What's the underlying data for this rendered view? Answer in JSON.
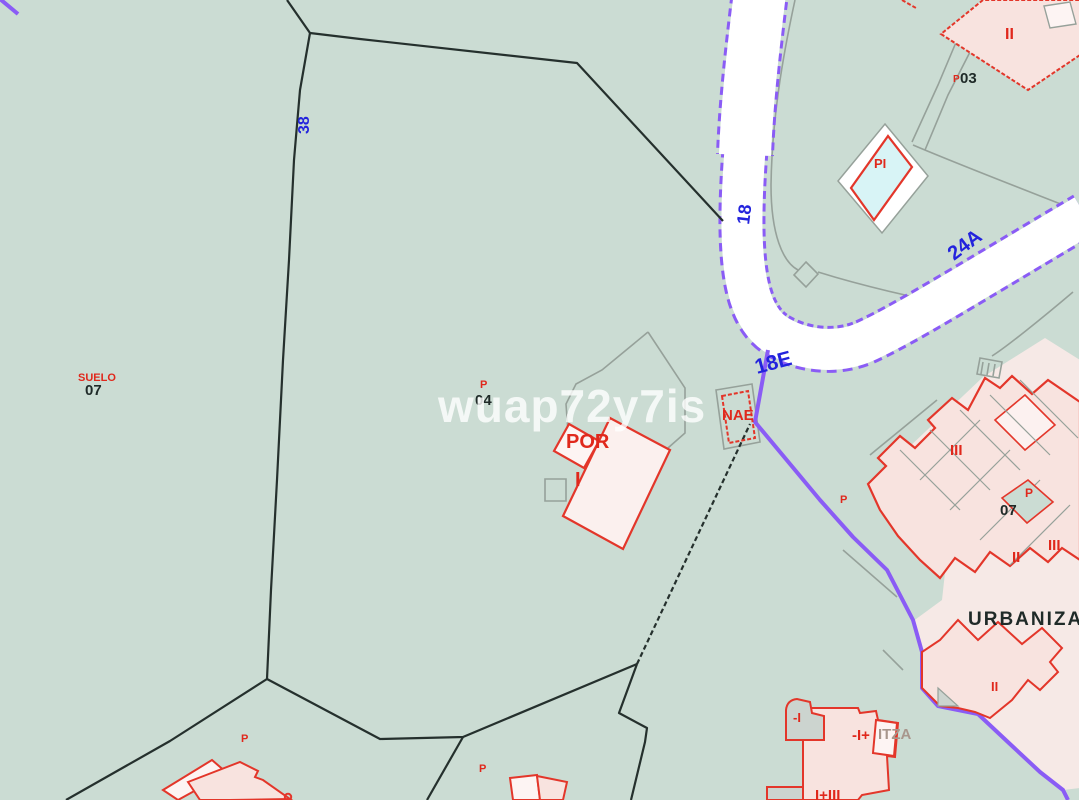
{
  "labels": {
    "watermark": "wuap72y7is",
    "roads": {
      "r38": "38",
      "r18": "18",
      "r18e": "18E",
      "r24a": "24A"
    },
    "parcels": {
      "suelo": "SUELO",
      "n07_left": "07",
      "n04": "04",
      "n03": "03",
      "n07_right": "07",
      "urban": "URBANIZA"
    },
    "buildings": {
      "por": "POR",
      "floor_i": "I",
      "nae": "NAE",
      "pool": "PI",
      "ii_top": "II",
      "iii_a": "III",
      "ii_mid": "II",
      "iii_b": "III",
      "ii_low": "II",
      "minus_i": "-I",
      "minus_i_plus": "-I+",
      "tza": "ITZA",
      "i_plus_iii": "I+III"
    },
    "porches": {
      "p1": "P",
      "p2": "P",
      "p3": "P",
      "p4": "P",
      "p5": "P",
      "p6": "P"
    }
  },
  "colors": {
    "background_green": "#cbdcd3",
    "urban_zone_pink": "#f6e9e6",
    "building_pink": "#f8e3df",
    "building_light": "#fdf4f3",
    "gray_fill": "#ccd4cf",
    "road_white": "#ffffff",
    "boundary_black": "#25302d",
    "boundary_gray": "#96a19a",
    "outline_red": "#e3362a",
    "label_red": "#e0281c",
    "label_blue": "#2323dd",
    "label_black": "#1f2a28",
    "zone_purple": "#8a5cf5",
    "pool_cyan": "#d8f4f6",
    "watermark_white": "#ffffff",
    "tza_tan": "#a8968c"
  }
}
